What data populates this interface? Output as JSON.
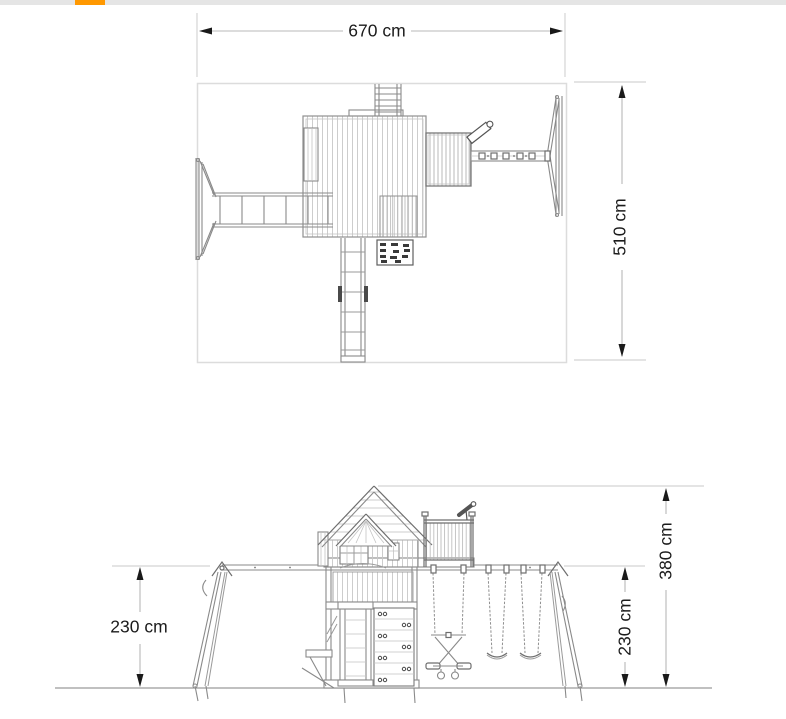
{
  "page": {
    "background": "#ffffff"
  },
  "progress_bar": {
    "track_color": "#e5e5e5",
    "indicator_color": "#ff9800"
  },
  "drawing": {
    "line_color": "#8a8a8a",
    "dimension_line_color": "#b8b8b8",
    "extension_line_color": "#d4d4d4",
    "arrow_color": "#1a1a1a",
    "text_color": "#1b1b1b",
    "dimension_arrow_icon": "filled-triangle"
  },
  "plan_view": {
    "width_label": "670 cm",
    "depth_label": "510 cm"
  },
  "side_view": {
    "left_height_label": "230 cm",
    "swing_height_label": "230 cm",
    "total_height_label": "380 cm"
  }
}
